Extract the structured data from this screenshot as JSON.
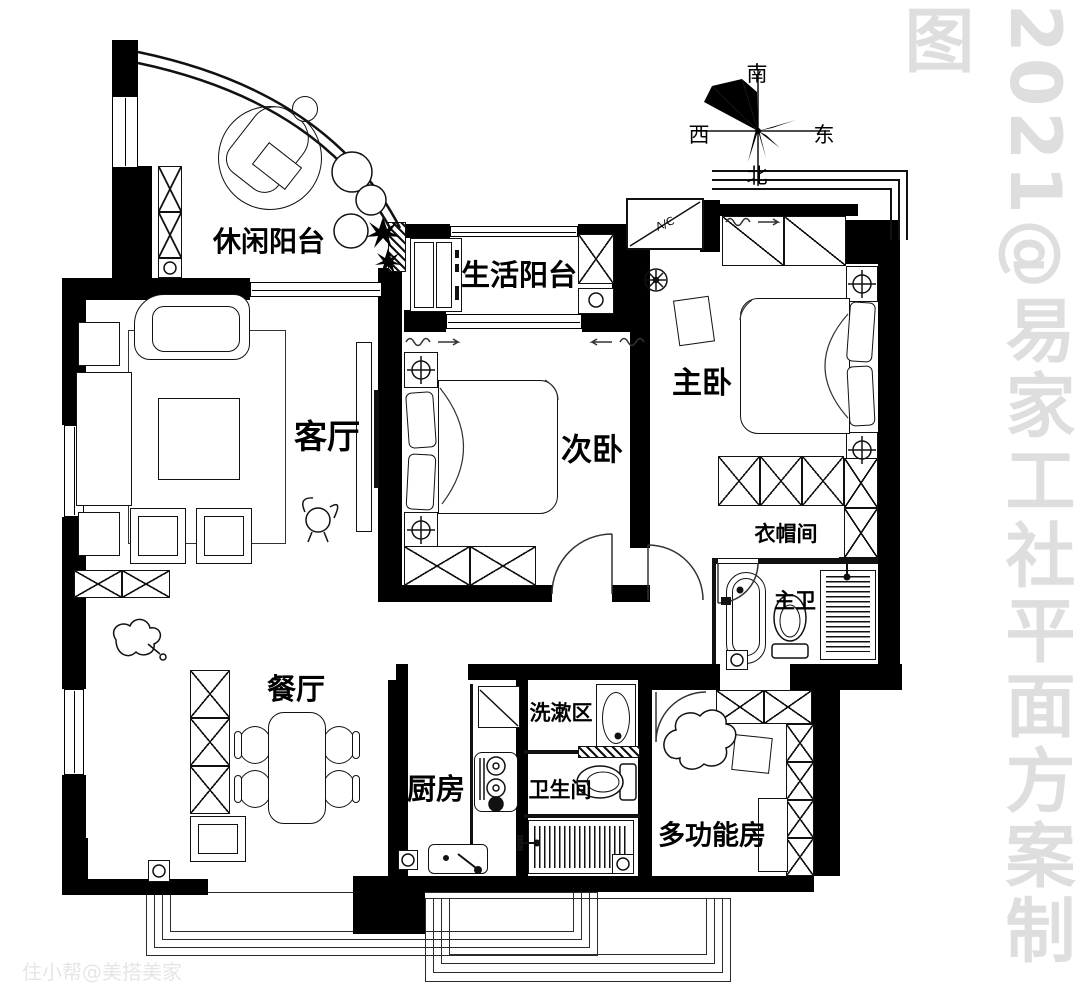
{
  "title": "三室两厅户型平面方案图",
  "rooms": {
    "leisure_balcony": "休闲阳台",
    "living_balcony": "生活阳台",
    "living_room": "客厅",
    "second_bedroom": "次卧",
    "master_bedroom": "主卧",
    "cloakroom": "衣帽间",
    "master_bath": "主卫",
    "dining_room": "餐厅",
    "kitchen": "厨房",
    "wash_area": "洗漱区",
    "bathroom": "卫生间",
    "multi_function_room": "多功能房"
  },
  "compass": {
    "south": "南",
    "west": "西",
    "east": "东",
    "north": "北"
  },
  "ac_unit": {
    "label": "A/C"
  },
  "watermarks": {
    "right_vertical": "2021@易家工社平面方案制图",
    "bottom_left": "住小帮@美搭美家"
  },
  "colors": {
    "wall": "#000000",
    "line": "#111111",
    "watermark": "#dedede",
    "background": "#ffffff"
  }
}
